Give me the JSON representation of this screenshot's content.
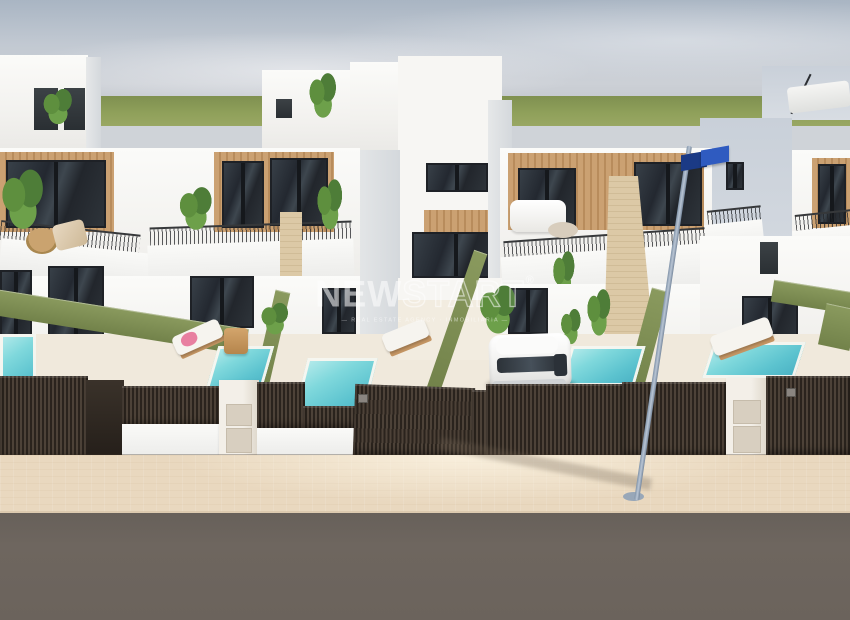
{
  "watermark": {
    "brand_solid": "NEW",
    "brand_outline": "START",
    "registered_mark": "®",
    "tagline": "— REAL ESTATE AGENCY · INMOBILIARIA —"
  },
  "scene": {
    "description": "3D architectural render of a row of modern two-storey white townhouses with wood-panel facades, roof terraces with plants, balconies with railings, private turquoise plunge pools, green hedge walls, dark slatted privacy fences and gates, a white SUV parked in the central driveway, a leaning street light with a blue street sign, and a beige paved sidewalk with asphalt road in the foreground"
  },
  "colors": {
    "sky_top": "#a9b5c3",
    "sky_horizon": "#ccd0d6",
    "field_green": "#8fa05a",
    "wall_white": "#f2f1ee",
    "wall_shaded": "#d4d8dc",
    "wood": "#cba172",
    "wood_dark": "#b88c5c",
    "glass_dark": "#232830",
    "glass_light": "#3e474f",
    "hedge_green": "#8a9a5e",
    "pool_teal": "#7fd8dc",
    "pool_deep": "#49b0c3",
    "fence_dark": "#2a231d",
    "fence_slat_light": "#4d4238",
    "pillar_white": "#f3efe8",
    "panel_beige": "#d8cfc0",
    "terrace": "#f0e9dc",
    "sidewalk": "#e9d8bf",
    "road": "#6e665f",
    "pole_gray": "#b9c5d4",
    "sign_blue_dark": "#1b3a85",
    "sign_blue_light": "#2f5bc0",
    "car_white": "#f1f1ef",
    "watermark_white": "#ffffff"
  }
}
